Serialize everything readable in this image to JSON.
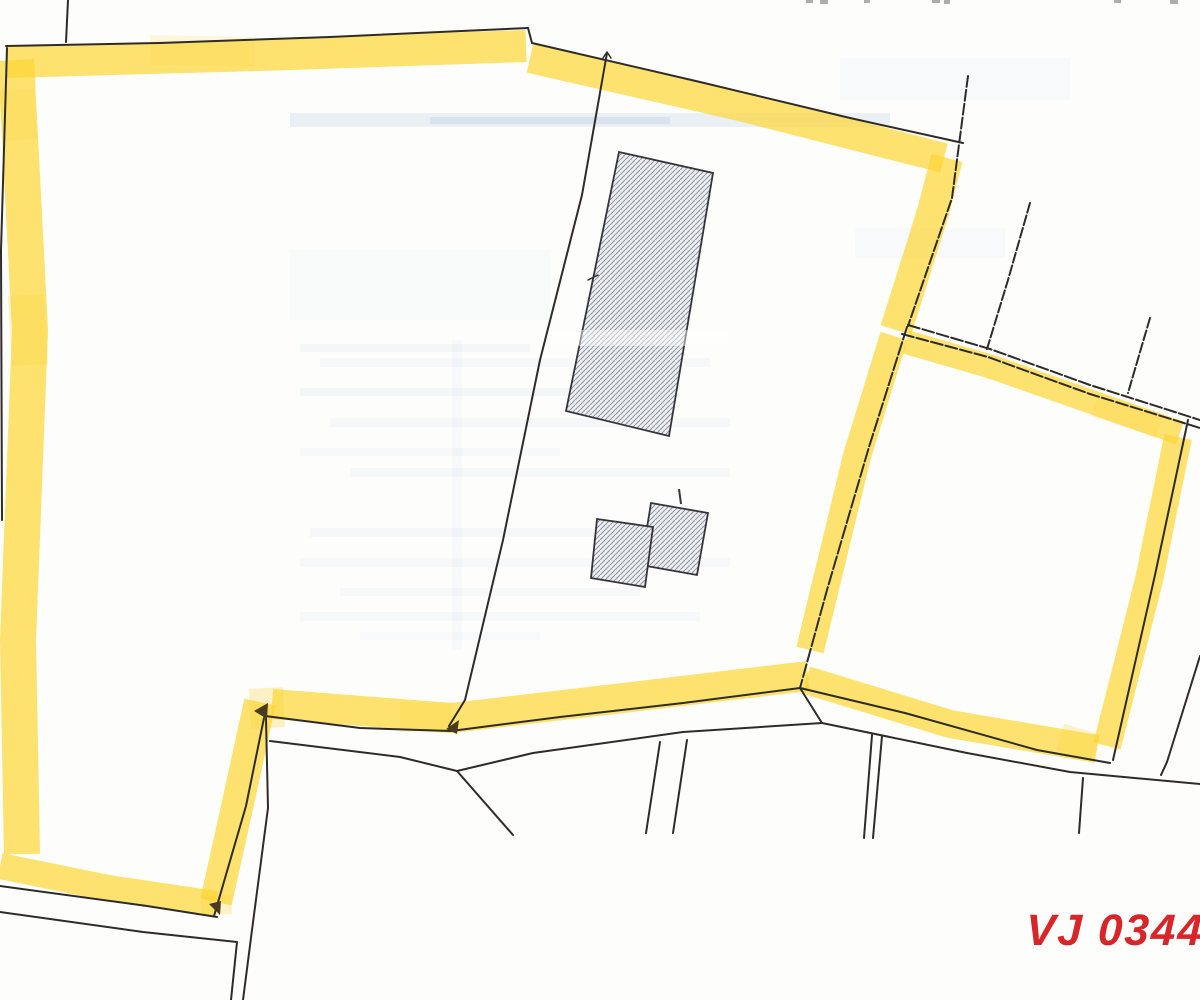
{
  "label": {
    "text": "VJ 0344",
    "color": "#d7262a"
  },
  "palette": {
    "paper": "#fdfdfc",
    "line": "#2e2c28",
    "highlight": "#fcd535",
    "highlight_opacity": 0.7,
    "hatch_fill": "#edeff2",
    "hatch_line": "#9096a0",
    "building_outline": "#35343a",
    "artifact_blue": "#9db8d6",
    "arrow": "#4a3a1e",
    "edge_mark": "#8a8a8a"
  },
  "scan_artifacts": [
    {
      "name": "scan-streak",
      "x": 290,
      "y": 113,
      "w": 600,
      "h": 14,
      "o": 0.18
    },
    {
      "name": "scan-streak",
      "x": 430,
      "y": 117,
      "w": 240,
      "h": 7,
      "o": 0.22
    },
    {
      "name": "scan-streak",
      "x": 300,
      "y": 344,
      "w": 230,
      "h": 8,
      "o": 0.09
    },
    {
      "name": "scan-streak",
      "x": 320,
      "y": 358,
      "w": 390,
      "h": 9,
      "o": 0.08
    },
    {
      "name": "scan-streak",
      "x": 300,
      "y": 388,
      "w": 360,
      "h": 8,
      "o": 0.09
    },
    {
      "name": "scan-streak",
      "x": 330,
      "y": 418,
      "w": 400,
      "h": 9,
      "o": 0.08
    },
    {
      "name": "scan-streak",
      "x": 300,
      "y": 448,
      "w": 260,
      "h": 8,
      "o": 0.07
    },
    {
      "name": "scan-streak",
      "x": 350,
      "y": 468,
      "w": 380,
      "h": 9,
      "o": 0.08
    },
    {
      "name": "scan-streak",
      "x": 310,
      "y": 528,
      "w": 380,
      "h": 9,
      "o": 0.08
    },
    {
      "name": "scan-streak",
      "x": 300,
      "y": 558,
      "w": 430,
      "h": 9,
      "o": 0.07
    },
    {
      "name": "scan-streak",
      "x": 340,
      "y": 588,
      "w": 300,
      "h": 8,
      "o": 0.07
    },
    {
      "name": "scan-streak",
      "x": 300,
      "y": 612,
      "w": 400,
      "h": 9,
      "o": 0.07
    },
    {
      "name": "scan-streak",
      "x": 360,
      "y": 632,
      "w": 180,
      "h": 8,
      "o": 0.06
    },
    {
      "name": "scan-streak",
      "x": 840,
      "y": 58,
      "w": 230,
      "h": 42,
      "o": 0.05
    },
    {
      "name": "scan-streak",
      "x": 855,
      "y": 228,
      "w": 150,
      "h": 30,
      "o": 0.05
    },
    {
      "name": "scan-streak",
      "x": 452,
      "y": 340,
      "w": 10,
      "h": 310,
      "o": 0.05
    },
    {
      "name": "scan-streak",
      "x": 290,
      "y": 250,
      "w": 260,
      "h": 70,
      "o": 0.04
    }
  ],
  "highlight_bands": [
    {
      "name": "highlight-top-west",
      "pts": [
        [
          6,
          62
        ],
        [
          260,
          55
        ],
        [
          526,
          46
        ]
      ],
      "w": 32
    },
    {
      "name": "highlight-top-east",
      "pts": [
        [
          530,
          58
        ],
        [
          740,
          106
        ],
        [
          944,
          158
        ]
      ],
      "w": 30
    },
    {
      "name": "highlight-east-upper",
      "pts": [
        [
          947,
          158
        ],
        [
          933,
          212
        ],
        [
          896,
          330
        ]
      ],
      "w": 32
    },
    {
      "name": "highlight-east-mid",
      "pts": [
        [
          894,
          336
        ],
        [
          857,
          456
        ],
        [
          810,
          650
        ]
      ],
      "w": 28
    },
    {
      "name": "highlight-south",
      "pts": [
        [
          808,
          676
        ],
        [
          640,
          696
        ],
        [
          452,
          718
        ],
        [
          272,
          704
        ]
      ],
      "w": 30
    },
    {
      "name": "highlight-southwest-steep",
      "pts": [
        [
          260,
          702
        ],
        [
          236,
          812
        ],
        [
          216,
          902
        ]
      ],
      "w": 32
    },
    {
      "name": "highlight-southwest",
      "pts": [
        [
          216,
          904
        ],
        [
          108,
          888
        ],
        [
          0,
          866
        ]
      ],
      "w": 26
    },
    {
      "name": "highlight-west",
      "pts": [
        [
          16,
          60
        ],
        [
          30,
          330
        ],
        [
          18,
          640
        ],
        [
          22,
          854
        ]
      ],
      "w": 36
    },
    {
      "name": "highlight-rparcel-top",
      "pts": [
        [
          906,
          342
        ],
        [
          992,
          367
        ],
        [
          1180,
          433
        ]
      ],
      "w": 24
    },
    {
      "name": "highlight-rparcel-east",
      "pts": [
        [
          1178,
          437
        ],
        [
          1149,
          580
        ],
        [
          1107,
          746
        ]
      ],
      "w": 28
    },
    {
      "name": "highlight-rparcel-south",
      "pts": [
        [
          806,
          680
        ],
        [
          950,
          724
        ],
        [
          1097,
          749
        ]
      ],
      "w": 28
    }
  ],
  "highlight_patches": [
    {
      "name": "highlight-overlap",
      "pts": [
        [
          266,
          688
        ],
        [
          268,
          728
        ]
      ],
      "w": 34,
      "o": 0.28
    },
    {
      "name": "highlight-overlap",
      "pts": [
        [
          26,
          295
        ],
        [
          30,
          365
        ]
      ],
      "w": 36,
      "o": 0.25
    },
    {
      "name": "highlight-overlap",
      "pts": [
        [
          400,
          717
        ],
        [
          452,
          718
        ]
      ],
      "w": 30,
      "o": 0.22
    },
    {
      "name": "highlight-overlap",
      "pts": [
        [
          1060,
          737
        ],
        [
          1096,
          748
        ]
      ],
      "w": 28,
      "o": 0.25
    },
    {
      "name": "highlight-overlap",
      "pts": [
        [
          216,
          895
        ],
        [
          217,
          915
        ]
      ],
      "w": 30,
      "o": 0.25
    },
    {
      "name": "highlight-overlap",
      "pts": [
        [
          150,
          50
        ],
        [
          255,
          52
        ]
      ],
      "w": 30,
      "o": 0.16
    },
    {
      "name": "highlight-overlap",
      "pts": [
        [
          16,
          90
        ],
        [
          20,
          140
        ]
      ],
      "w": 34,
      "o": 0.2
    },
    {
      "name": "highlight-overlap",
      "pts": [
        [
          1095,
          405
        ],
        [
          1160,
          426
        ]
      ],
      "w": 24,
      "o": 0.2
    }
  ],
  "buildings": [
    {
      "name": "building-large-hatched",
      "pts": [
        [
          619,
          152
        ],
        [
          713,
          173
        ],
        [
          669,
          436
        ],
        [
          566,
          411
        ]
      ]
    },
    {
      "name": "building-small-hatched-east",
      "pts": [
        [
          651,
          503
        ],
        [
          708,
          513
        ],
        [
          697,
          575
        ],
        [
          641,
          565
        ]
      ]
    },
    {
      "name": "building-small-hatched-west",
      "pts": [
        [
          597,
          519
        ],
        [
          653,
          527
        ],
        [
          645,
          587
        ],
        [
          591,
          578
        ]
      ]
    }
  ],
  "building_details": [
    {
      "name": "building-antenna-tick",
      "pts": [
        [
          679,
          489
        ],
        [
          681,
          504
        ]
      ],
      "w": 2
    }
  ],
  "boundary_lines": [
    {
      "name": "survey-line-top-stub",
      "pts": [
        [
          68,
          0
        ],
        [
          66,
          42
        ]
      ],
      "w": 2
    },
    {
      "name": "parcel-boundary-north",
      "pts": [
        [
          6,
          46
        ],
        [
          160,
          43
        ],
        [
          330,
          37
        ],
        [
          528,
          28
        ]
      ],
      "w": 2
    },
    {
      "name": "parcel-boundary-north-notch",
      "pts": [
        [
          528,
          28
        ],
        [
          532,
          43
        ]
      ],
      "w": 2
    },
    {
      "name": "parcel-boundary-northeast",
      "pts": [
        [
          532,
          43
        ],
        [
          700,
          82
        ],
        [
          850,
          118
        ],
        [
          963,
          143
        ]
      ],
      "w": 2
    },
    {
      "name": "parcel-boundary-east-upper",
      "pts": [
        [
          968,
          76
        ],
        [
          952,
          198
        ],
        [
          908,
          326
        ]
      ],
      "w": 2,
      "dash": "11 3"
    },
    {
      "name": "parcel-boundary-west",
      "pts": [
        [
          7,
          48
        ],
        [
          1,
          250
        ],
        [
          2,
          520
        ]
      ],
      "w": 2
    },
    {
      "name": "interior-survey-line",
      "pts": [
        [
          607,
          53
        ],
        [
          582,
          195
        ],
        [
          540,
          360
        ],
        [
          503,
          540
        ],
        [
          465,
          700
        ],
        [
          449,
          726
        ]
      ],
      "w": 2
    },
    {
      "name": "interior-survey-tick",
      "pts": [
        [
          603,
          58
        ],
        [
          607,
          52
        ],
        [
          611,
          58
        ]
      ],
      "w": 1.5
    },
    {
      "name": "interior-survey-tick",
      "pts": [
        [
          588,
          280
        ],
        [
          598,
          275
        ]
      ],
      "w": 1.5
    },
    {
      "name": "division-line-a",
      "pts": [
        [
          1030,
          203
        ],
        [
          1008,
          280
        ],
        [
          987,
          349
        ]
      ],
      "w": 2,
      "dash": "10 3"
    },
    {
      "name": "division-line-b",
      "pts": [
        [
          1150,
          318
        ],
        [
          1128,
          393
        ]
      ],
      "w": 2,
      "dash": "10 3"
    },
    {
      "name": "rparcel-top-line-outer",
      "pts": [
        [
          908,
          325
        ],
        [
          990,
          349
        ],
        [
          1090,
          385
        ],
        [
          1200,
          420
        ]
      ],
      "w": 2,
      "dash": "12 3"
    },
    {
      "name": "rparcel-top-line-inner",
      "pts": [
        [
          902,
          334
        ],
        [
          988,
          357
        ],
        [
          1090,
          394
        ],
        [
          1200,
          428
        ]
      ],
      "w": 2,
      "dash": "12 3"
    },
    {
      "name": "rparcel-boundary-south",
      "pts": [
        [
          800,
          688
        ],
        [
          905,
          713
        ],
        [
          1037,
          750
        ],
        [
          1110,
          763
        ]
      ],
      "w": 2
    },
    {
      "name": "parcel-boundary-east-mid",
      "pts": [
        [
          907,
          327
        ],
        [
          869,
          447
        ],
        [
          827,
          590
        ],
        [
          800,
          688
        ]
      ],
      "w": 2,
      "dash": "13 3"
    },
    {
      "name": "parcel-boundary-south",
      "pts": [
        [
          265,
          716
        ],
        [
          360,
          728
        ],
        [
          451,
          731
        ],
        [
          560,
          717
        ],
        [
          683,
          703
        ],
        [
          800,
          688
        ]
      ],
      "w": 2
    },
    {
      "name": "parcel-boundary-southwest-steep",
      "pts": [
        [
          264,
          718
        ],
        [
          246,
          806
        ],
        [
          214,
          916
        ]
      ],
      "w": 2
    },
    {
      "name": "road-line-southwest-upper",
      "pts": [
        [
          0,
          886
        ],
        [
          147,
          906
        ],
        [
          217,
          917
        ]
      ],
      "w": 2
    },
    {
      "name": "road-line-southwest-lower",
      "pts": [
        [
          0,
          912
        ],
        [
          143,
          932
        ],
        [
          237,
          942
        ],
        [
          231,
          1000
        ]
      ],
      "w": 2
    },
    {
      "name": "road-line-south-diagonal",
      "pts": [
        [
          266,
          719
        ],
        [
          268,
          808
        ],
        [
          252,
          930
        ],
        [
          243,
          1000
        ]
      ],
      "w": 2
    },
    {
      "name": "road-line-south-parallel",
      "pts": [
        [
          270,
          741
        ],
        [
          400,
          757
        ],
        [
          457,
          771
        ],
        [
          533,
          753
        ],
        [
          683,
          732
        ],
        [
          822,
          723
        ]
      ],
      "w": 2
    },
    {
      "name": "road-branch-line",
      "pts": [
        [
          457,
          771
        ],
        [
          513,
          835
        ]
      ],
      "w": 2
    },
    {
      "name": "lane-line-a",
      "pts": [
        [
          660,
          742
        ],
        [
          646,
          833
        ]
      ],
      "w": 2
    },
    {
      "name": "lane-line-b",
      "pts": [
        [
          687,
          740
        ],
        [
          673,
          833
        ]
      ],
      "w": 2
    },
    {
      "name": "lane-line-c",
      "pts": [
        [
          872,
          735
        ],
        [
          864,
          838
        ]
      ],
      "w": 2
    },
    {
      "name": "lane-line-d",
      "pts": [
        [
          882,
          736
        ],
        [
          873,
          838
        ]
      ],
      "w": 2
    },
    {
      "name": "lane-line-e",
      "pts": [
        [
          1083,
          778
        ],
        [
          1079,
          833
        ]
      ],
      "w": 2
    },
    {
      "name": "road-line-southeast",
      "pts": [
        [
          822,
          723
        ],
        [
          967,
          753
        ],
        [
          1070,
          772
        ],
        [
          1200,
          784
        ]
      ],
      "w": 2
    },
    {
      "name": "junction-connector",
      "pts": [
        [
          800,
          688
        ],
        [
          822,
          723
        ]
      ],
      "w": 2
    },
    {
      "name": "road-line-east-diagonal",
      "pts": [
        [
          1200,
          656
        ],
        [
          1167,
          762
        ],
        [
          1161,
          775
        ]
      ],
      "w": 2
    },
    {
      "name": "rparcel-boundary-east",
      "pts": [
        [
          1188,
          420
        ],
        [
          1155,
          575
        ],
        [
          1113,
          760
        ]
      ],
      "w": 2
    }
  ],
  "arrows": [
    {
      "name": "survey-arrowhead",
      "pts": [
        [
          446,
          729
        ],
        [
          459,
          720
        ],
        [
          457,
          734
        ]
      ]
    },
    {
      "name": "survey-arrowhead",
      "pts": [
        [
          254,
          711
        ],
        [
          268,
          703
        ],
        [
          267,
          719
        ]
      ]
    },
    {
      "name": "survey-arrowhead",
      "pts": [
        [
          220,
          915
        ],
        [
          209,
          904
        ],
        [
          221,
          901
        ]
      ]
    }
  ],
  "overlays": [
    {
      "name": "scan-fade",
      "x": 552,
      "y": 330,
      "w": 175,
      "h": 16,
      "color": "#ffffff",
      "o": 0.45
    }
  ],
  "edge_marks": [
    {
      "name": "cutoff-text-mark",
      "x": 806,
      "y": 0,
      "w": 7,
      "h": 3
    },
    {
      "name": "cutoff-text-mark",
      "x": 820,
      "y": 0,
      "w": 8,
      "h": 4
    },
    {
      "name": "cutoff-text-mark",
      "x": 864,
      "y": 0,
      "w": 6,
      "h": 3
    },
    {
      "name": "cutoff-text-mark",
      "x": 932,
      "y": 0,
      "w": 8,
      "h": 3
    },
    {
      "name": "cutoff-text-mark",
      "x": 944,
      "y": 0,
      "w": 6,
      "h": 4
    },
    {
      "name": "cutoff-text-mark",
      "x": 1114,
      "y": 0,
      "w": 7,
      "h": 3
    },
    {
      "name": "cutoff-text-mark",
      "x": 1170,
      "y": 0,
      "w": 8,
      "h": 4
    }
  ]
}
